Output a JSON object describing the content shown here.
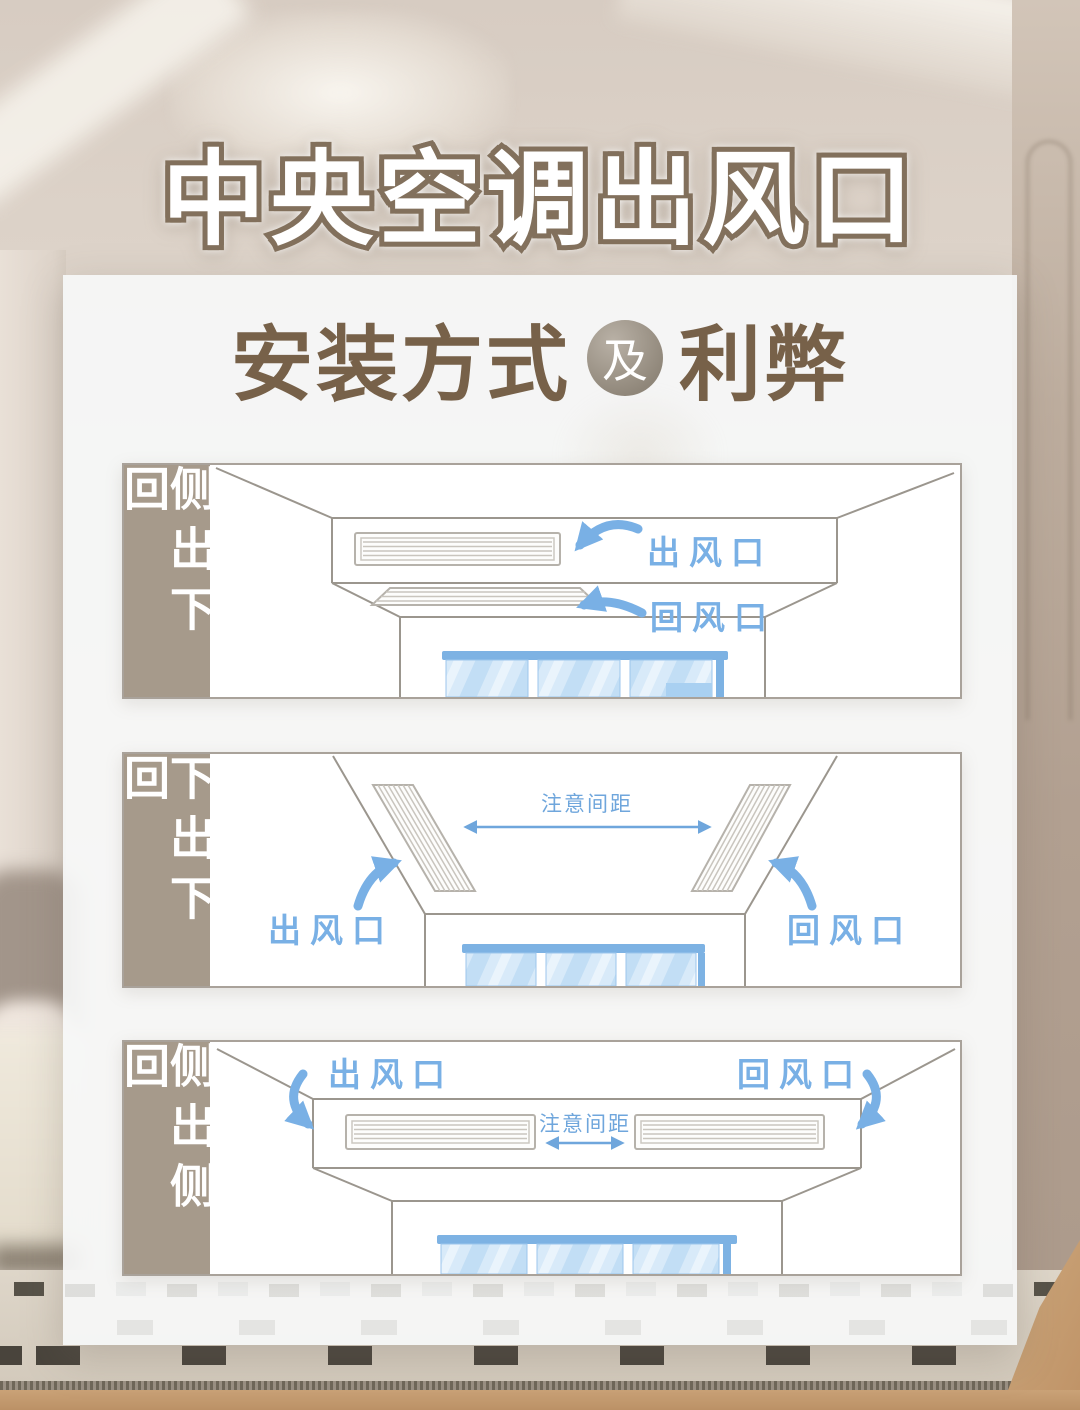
{
  "header": {
    "title": "中央空调出风口",
    "subtitle": {
      "left": "安装方式",
      "conjunction": "及",
      "right": "利弊"
    }
  },
  "panels": [
    {
      "method": "侧出下回",
      "annotations": {
        "outlet": "出风口",
        "return": "回风口"
      }
    },
    {
      "method": "下出下回",
      "annotations": {
        "outlet": "出风口",
        "return": "回风口",
        "spacing": "注意间距"
      }
    },
    {
      "method": "侧出侧回",
      "annotations": {
        "outlet": "出风口",
        "return": "回风口",
        "spacing": "注意间距"
      }
    }
  ],
  "colors": {
    "annotation_blue": "#79b0e5",
    "note_blue": "#6fa6dc",
    "label_bar_taupe": "#a69a8b",
    "title_outline_brown": "#82705c",
    "subtitle_brown": "#776149",
    "diagram_line_gray": "#9b968e",
    "window_frame_blue": "#7db2e3",
    "glass_blue": "#d8eaf9"
  }
}
